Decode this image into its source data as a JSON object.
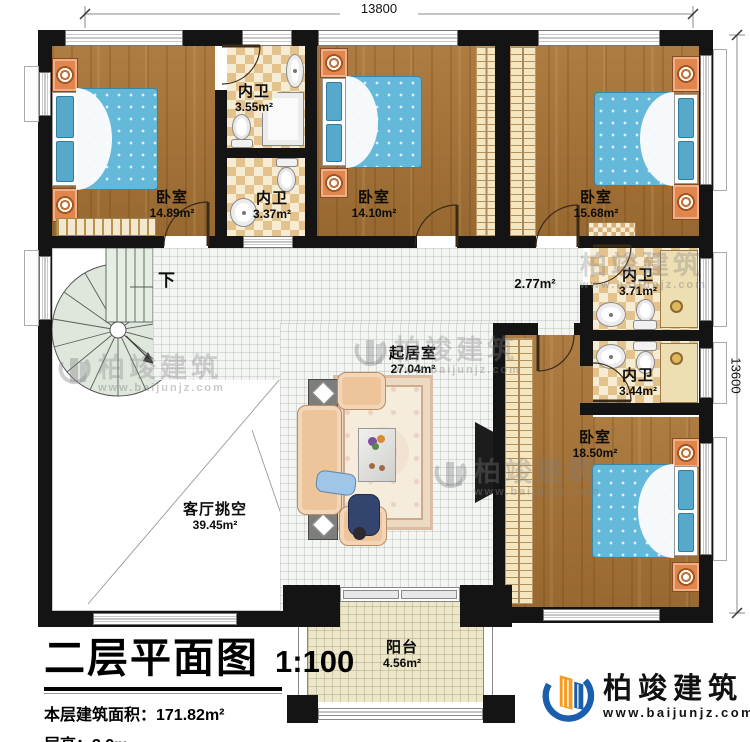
{
  "dimensions": {
    "top": "13800",
    "right": "13600"
  },
  "rooms": {
    "bedroom_tl": {
      "label": "卧室",
      "area": "14.89m²"
    },
    "bath_a": {
      "label": "内卫",
      "area": "3.55m²"
    },
    "bath_b": {
      "label": "内卫",
      "area": "3.37m²"
    },
    "bedroom_tm": {
      "label": "卧室",
      "area": "14.10m²"
    },
    "bedroom_tr": {
      "label": "卧室",
      "area": "15.68m²"
    },
    "bath_c": {
      "label": "内卫",
      "area": "3.71m²"
    },
    "bath_d": {
      "label": "内卫",
      "area": "3.44m²"
    },
    "hall": {
      "area": "2.77m²"
    },
    "living": {
      "label": "起居室",
      "area": "27.04m²"
    },
    "void": {
      "label": "客厅挑空",
      "area": "39.45m²"
    },
    "bedroom_br": {
      "label": "卧室",
      "area": "18.50m²"
    },
    "balcony": {
      "label": "阳台",
      "area": "4.56m²"
    },
    "stairs": {
      "label": "下"
    }
  },
  "title_block": {
    "title": "二层平面图",
    "scale": "1:100",
    "floor_area": "本层建筑面积：171.82m²",
    "floor_height": "层高：3.9m"
  },
  "branding": {
    "company": "柏竣建筑",
    "website": "www.baijunjz.com"
  }
}
